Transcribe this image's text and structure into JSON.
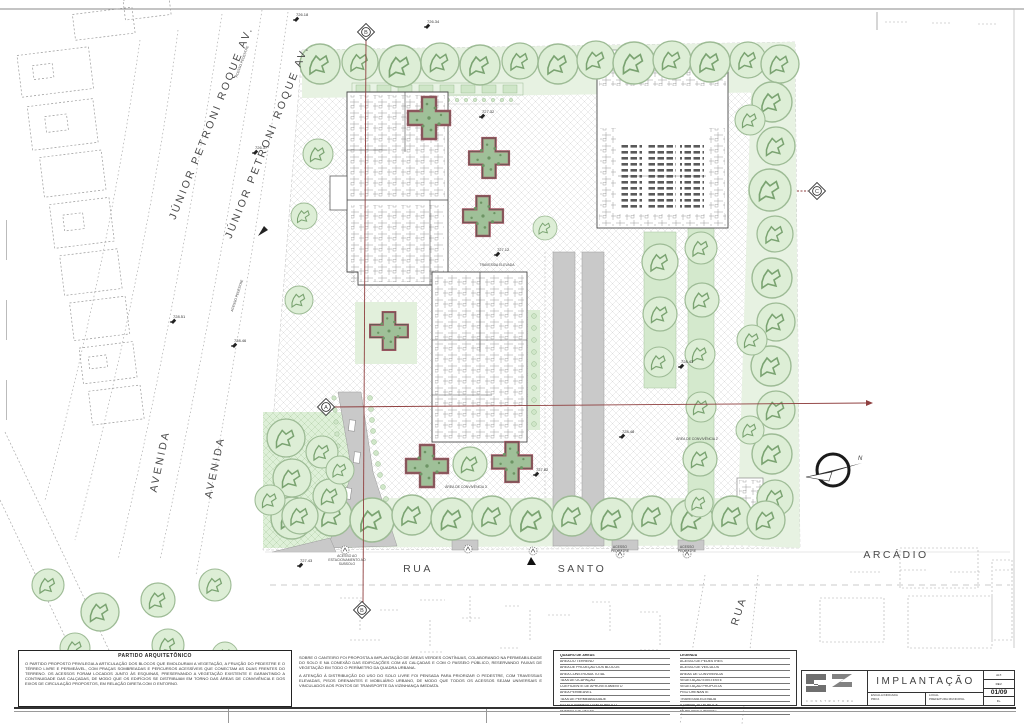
{
  "sheet": {
    "drawing_type": "site plan"
  },
  "streets": {
    "avenue": "JÚNIOR  PETRONI  ROQUE  AV.",
    "avenida": "AVENIDA",
    "rua": "RUA",
    "santo": "SANTO",
    "arcadio": "ARCÁDIO",
    "rua_side": "RUA"
  },
  "labels": {
    "north": "N",
    "acesso_pedestre": "ACESSO PEDESTRE",
    "acesso": "ACESSO",
    "pedestre": "PEDESTRE",
    "acesso_sub1": "ACESSO AO",
    "acesso_sub2": "ESTACIONAMENTO AO",
    "acesso_sub3": "SUBSOLO",
    "area_convivencia_2": "ÁREA DE CONVIVÊNCIA 2",
    "area_convivencia_3": "ÁREA DE CONVIVÊNCIA 3",
    "travessia": "TRAVESSIA ELEVADA"
  },
  "markers": {
    "a": "A",
    "b": "B",
    "c": "C"
  },
  "elevations": [
    "726.18",
    "726.34",
    "726.37",
    "727.32",
    "727.12",
    "728.51",
    "728.46",
    "727.43",
    "728.43",
    "728.48",
    "727.82"
  ],
  "notes_left": {
    "title": "PARTIDO ARQUITETÔNICO",
    "text": "O PARTIDO PROPOSTO PRIVILEGIA A ARTICULAÇÃO DOS BLOCOS QUE EMOLDURAM A VEGETAÇÃO, A FRUIÇÃO DO PEDESTRE E O TÉRREO LIVRE E PERMEÁVEL, COM PRAÇAS SOMBREADAS E PERCURSOS ACESSÍVEIS QUE CONECTAM AS DUAS FRENTES DO TERRENO. OS ACESSOS FORAM LOCADOS JUNTO ÀS ESQUINAS, PRESERVANDO A VEGETAÇÃO EXISTENTE E GARANTINDO A CONTINUIDADE DAS CALÇADAS, DE MODO QUE OS EDIFÍCIOS SE DISTRIBUAM EM TORNO DAS ÁREAS DE CONVIVÊNCIA E DOS EIXOS DE CIRCULAÇÃO PROPOSTOS, EM RELAÇÃO DIRETA COM O ENTORNO."
  },
  "notes_middle": {
    "p1": "SOBRE O CANTEIRO FOI PROPOSTA A IMPLANTAÇÃO DE ÁREAS VERDES CONTÍNUAS, COLABORANDO NA PERMEABILIDADE DO SOLO E NA CONEXÃO DAS EDIFICAÇÕES COM AS CALÇADAS E COM O PASSEIO PÚBLICO, RESERVANDO FAIXAS DE VEGETAÇÃO EM TODO O PERÍMETRO DA QUADRA URBANA.",
    "p2": "A ATENÇÃO À DISTRIBUIÇÃO DO USO DO SOLO LIVRE FOI PENSADA PARA PRIORIZAR O PEDESTRE, COM TRAVESSIAS ELEVADAS, PISOS DRENANTES E MOBILIÁRIO URBANO, DE MODO QUE TODOS OS ACESSOS SEJAM UNIVERSAIS E VINCULADOS AOS PONTOS DE TRANSPORTE DA VIZINHANÇA IMEDIATA."
  },
  "legend": {
    "left_rows": [
      "QUADRO DE ÁREAS",
      "ÁREA DO TERRENO",
      "ÁREA DE PROJEÇÃO DOS BLOCOS",
      "ÁREA CONSTRUÍDA TOTAL",
      "TAXA DE OCUPAÇÃO",
      "COEFICIENTE DE APROVEITAMENTO",
      "ÁREA PERMEÁVEL",
      "TAXA DE PERMEABILIDADE",
      "ESTACIONAMENTO EM SUBSOLO",
      "NÚMERO DE VAGAS"
    ],
    "right_rows": [
      "LEGENDA",
      "ACESSO DE PEDESTRES",
      "ACESSO DE VEÍCULOS",
      "ÁREAS DE CONVIVÊNCIA",
      "VEGETAÇÃO EXISTENTE",
      "VEGETAÇÃO PROPOSTA",
      "PISO DRENANTE",
      "TRAVESSIA ELEVADA",
      "ILUMINAÇÃO PÚBLICA",
      "MOBILIÁRIO URBANO"
    ]
  },
  "title_block": {
    "title": "IMPLANTAÇÃO",
    "logo_caption": "C O N S T R U T O R A",
    "scale_label": "ESCALA INDICADA",
    "scale_value": "PROJ.",
    "local_label": "LOCAL",
    "local_value": "PREFEITURA MUNICIPAL",
    "right_rows": [
      "ALT.",
      "REV.",
      "01/09",
      "FL."
    ]
  }
}
